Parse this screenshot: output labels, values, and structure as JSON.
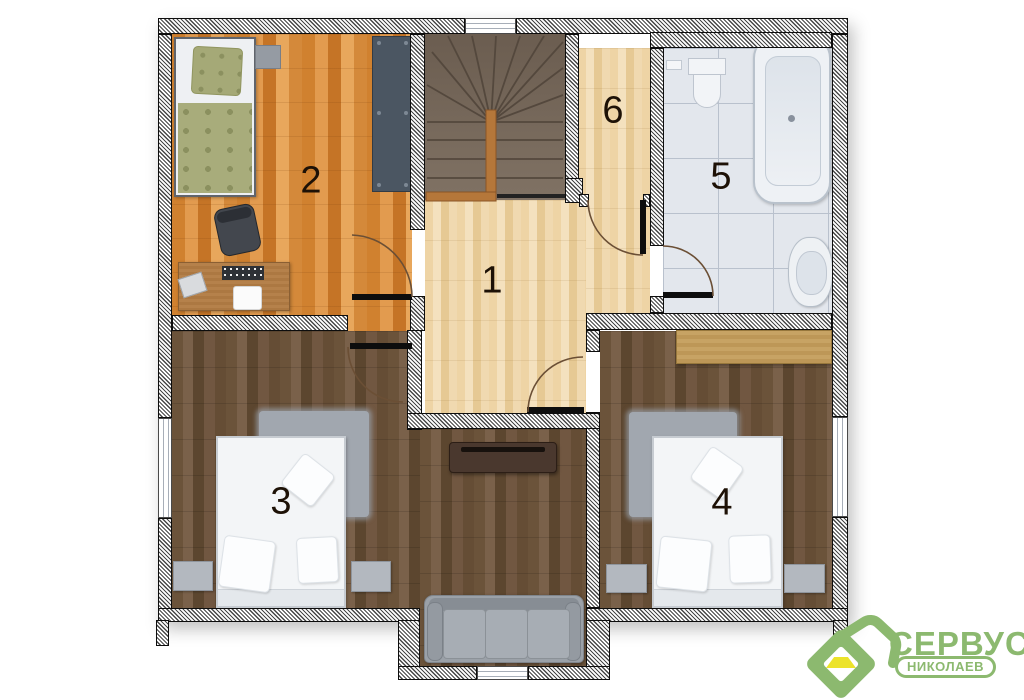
{
  "plan": {
    "rooms": {
      "hall": {
        "label": "1"
      },
      "bedroom_top": {
        "label": "2"
      },
      "bedroom_left": {
        "label": "3"
      },
      "bedroom_right": {
        "label": "4"
      },
      "bathroom": {
        "label": "5"
      },
      "closet": {
        "label": "6"
      }
    }
  },
  "logo": {
    "brand": "СЕРВУС",
    "city": "НИКОЛАЕВ",
    "green": "#8cb96f",
    "yellow": "#ece32b"
  }
}
